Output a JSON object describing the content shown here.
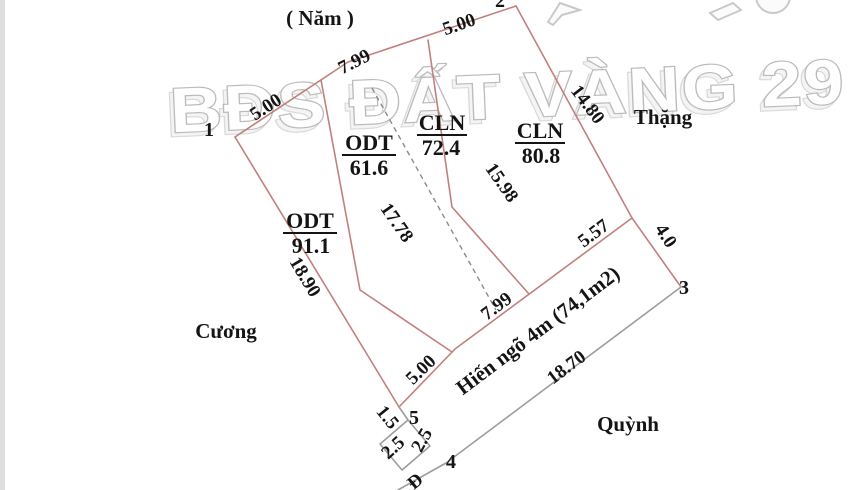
{
  "watermark": {
    "text": "BĐS ĐẤT VÀNG 29"
  },
  "neighbors": {
    "top": "( Năm )",
    "left": "Cương",
    "right": "Thặng",
    "bottom": "Quỳnh"
  },
  "parcels": [
    {
      "type": "ODT",
      "area": "91.1"
    },
    {
      "type": "ODT",
      "area": "61.6"
    },
    {
      "type": "CLN",
      "area": "72.4"
    },
    {
      "type": "CLN",
      "area": "80.8"
    }
  ],
  "alley": {
    "name": "Hiến ngõ 4m (74,1m2)",
    "length": "18.70"
  },
  "vertices": {
    "v1": "1",
    "v2": "2",
    "v3": "3",
    "v4": "4",
    "v5": "5"
  },
  "dims": {
    "top1": "5.00",
    "top2": "7.99",
    "top3": "5.00",
    "right1": "14.80",
    "right2": "4.0",
    "left1": "18.90",
    "alley1": "5.00",
    "alley2": "7.99",
    "alley3": "5.57",
    "divider_a": "17.78",
    "divider_b": "15.98",
    "edge_15": "1.5",
    "edge_25a": "2.5",
    "edge_25b": "2.5",
    "road_letter": "Đ"
  },
  "colors": {
    "boundary": "#c1807e",
    "gray": "#9d9d9d",
    "dashed": "#8a8a8a",
    "text": "#141414",
    "watermark_stroke": "#b8b8b8"
  }
}
